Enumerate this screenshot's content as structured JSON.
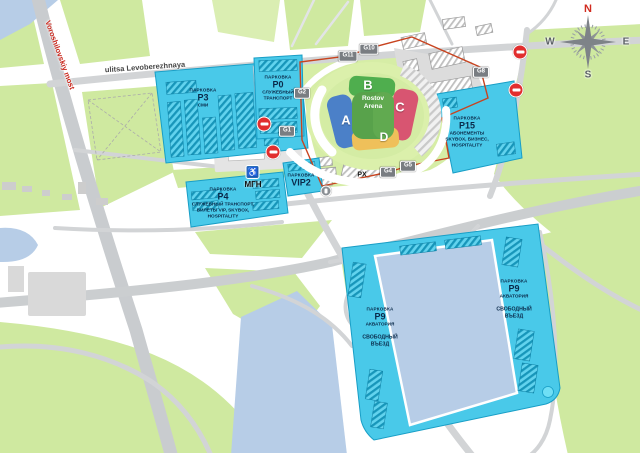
{
  "streets": {
    "bridge": "Voroshilovskiy most",
    "main_street": "ulitsa Levoberezhnaya"
  },
  "stadium": {
    "name": "Rostov Arena",
    "stands": {
      "a": "A",
      "b": "B",
      "c": "C",
      "d": "D"
    }
  },
  "gates": {
    "g1": "G1",
    "g2": "G2",
    "g4": "G4",
    "g5": "G5",
    "g8": "G8",
    "g10": "G10",
    "g11": "G11"
  },
  "compass": {
    "n": "N",
    "e": "E",
    "s": "S",
    "w": "W"
  },
  "poi": {
    "px": "PX",
    "mgn": "МГН",
    "wheelchair": "♿"
  },
  "parkings": {
    "p3": {
      "kicker": "ПАРКОВКА",
      "code": "P3",
      "desc": "СМИ"
    },
    "p0": {
      "kicker": "ПАРКОВКА",
      "code": "P0",
      "desc": "СЛУЖЕБНЫЙ ТРАНСПОРТ"
    },
    "p15": {
      "kicker": "ПАРКОВКА",
      "code": "P15",
      "desc": "АБОНЕМЕНТЫ SKYBOX, БИЗНЕС, HOSPITALITY"
    },
    "p4": {
      "kicker": "ПАРКОВКА",
      "code": "P4",
      "desc": "СЛУЖЕБНЫЙ ТРАНСПОРТ, БИЛЕТЫ VIP, SKYBOX, HOSPITALITY"
    },
    "vip2": {
      "kicker": "ПАРКОВКА",
      "code": "VIP2"
    },
    "p9_left": {
      "kicker": "ПАРКОВКА",
      "code": "P9",
      "desc": "АКВАТОРИЯ",
      "note": "СВОБОДНЫЙ ВЪЕЗД"
    },
    "p9_right": {
      "kicker": "ПАРКОВКА",
      "code": "P9",
      "desc": "АКВАТОРИЯ",
      "note": "СВОБОДНЫЙ ВЪЕЗД"
    }
  },
  "colors": {
    "parking_fill": "#49c9e9",
    "boundary": "#c8431f",
    "water": "#b7cde7",
    "green": "#cfe9a0",
    "stand_a": "#4b80c8",
    "stand_b": "#4fae4e",
    "stand_c": "#d85571",
    "stand_d": "#efc05a",
    "pitch": "#58a24b",
    "no_entry_sign": "#e12e2e"
  }
}
